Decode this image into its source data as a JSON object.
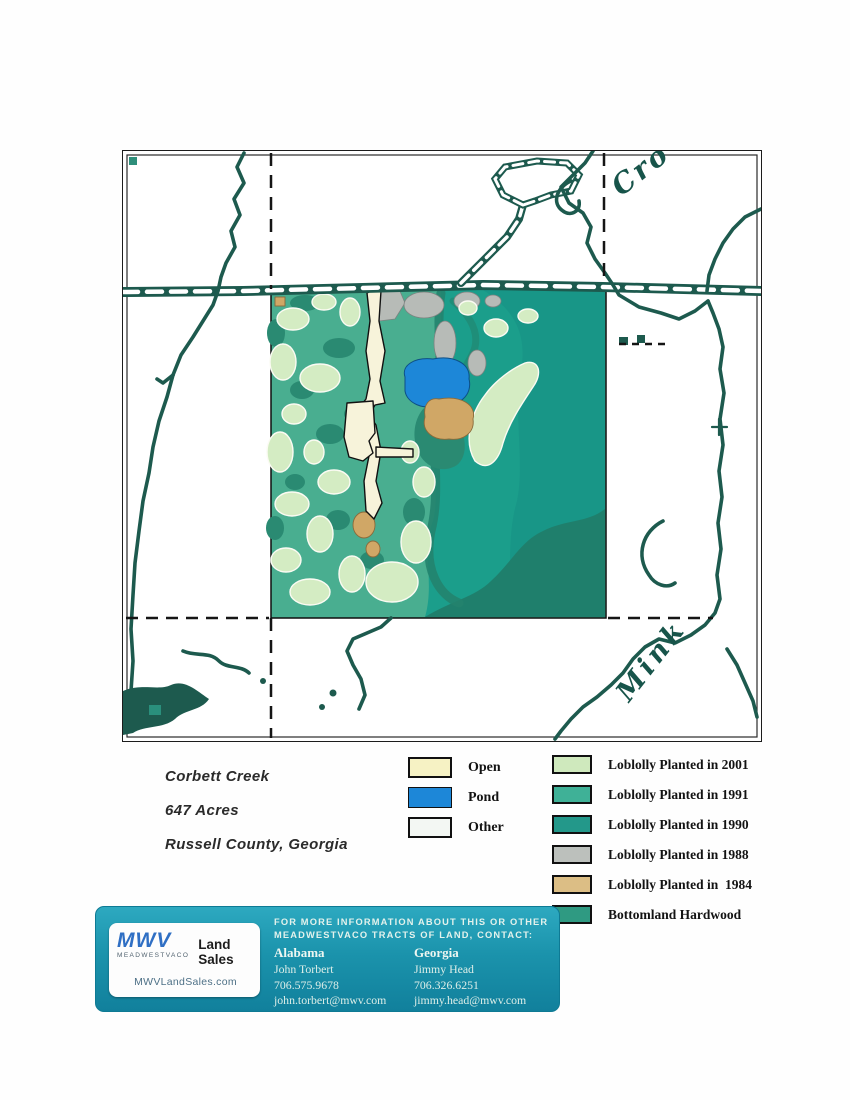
{
  "map": {
    "labels": {
      "creek_top": "Cro",
      "creek_bottom": "Mink"
    }
  },
  "property": {
    "name": "Corbett Creek",
    "acres": "647 Acres",
    "location": "Russell County, Georgia"
  },
  "legend_left": {
    "items": [
      {
        "label": "Open",
        "color": "#f6f2c4"
      },
      {
        "label": "Pond",
        "color": "#1d87d8"
      },
      {
        "label": "Other",
        "color": "#f3f7f3"
      }
    ]
  },
  "legend_right": {
    "items": [
      {
        "label": "Loblolly Planted in 2001",
        "color": "#cfe9bd"
      },
      {
        "label": "Loblolly Planted in 1991",
        "color": "#3fb197"
      },
      {
        "label": "Loblolly Planted in 1990",
        "color": "#23988a"
      },
      {
        "label": "Loblolly Planted in 1988",
        "color": "#bcc0bc"
      },
      {
        "label": "Loblolly Planted in  1984",
        "color": "#dcbe85"
      },
      {
        "label": "Bottomland Hardwood",
        "color": "#2f9a82"
      }
    ]
  },
  "footer": {
    "logo": {
      "brand": "MWV",
      "company": "MEADWESTVACO",
      "division": "Land Sales",
      "website": "MWVLandSales.com"
    },
    "heading_line1": "FOR MORE INFORMATION ABOUT THIS OR OTHER",
    "heading_line2": "MEADWESTVACO TRACTS OF LAND, CONTACT:",
    "contacts": [
      {
        "region": "Alabama",
        "name": "John Torbert",
        "phone": "706.575.9678",
        "email": "john.torbert@mwv.com"
      },
      {
        "region": "Georgia",
        "name": "Jimmy Head",
        "phone": "706.326.6251",
        "email": "jimmy.head@mwv.com"
      }
    ]
  }
}
